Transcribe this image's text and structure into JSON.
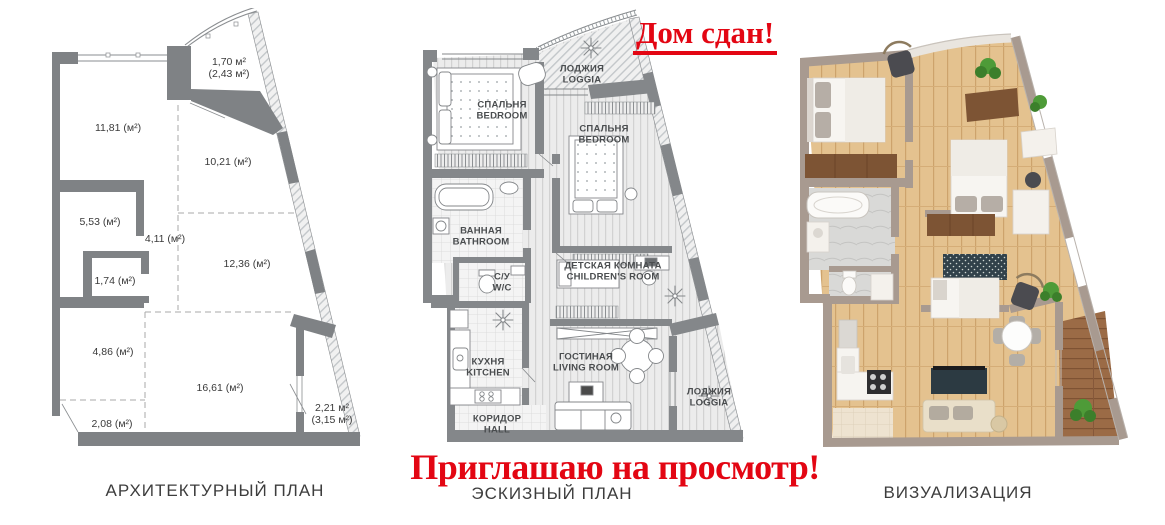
{
  "banners": {
    "top": "Дом сдан!",
    "bottom": "Приглашаю на просмотр!"
  },
  "panels": {
    "architectural": {
      "caption": "АРХИТЕКТУРНЫЙ ПЛАН",
      "rooms": [
        {
          "area": "11,81 (м²)"
        },
        {
          "area": "10,21 (м²)"
        },
        {
          "area": "5,53 (м²)"
        },
        {
          "area": "4,11 (м²)"
        },
        {
          "area": "1,74 (м²)"
        },
        {
          "area": "12,36 (м²)"
        },
        {
          "area": "4,86 (м²)"
        },
        {
          "area": "16,61 (м²)"
        },
        {
          "area": "2,08 (м²)"
        },
        {
          "area_line1": "2,21 м²",
          "area_line2": "(3,15 м²)"
        },
        {
          "area_line1": "1,70 м²",
          "area_line2": "(2,43 м²)"
        }
      ]
    },
    "sketch": {
      "caption": "ЭСКИЗНЫЙ ПЛАН",
      "rooms": [
        {
          "ru": "ЛОДЖИЯ",
          "en": "LOGGIA"
        },
        {
          "ru": "СПАЛЬНЯ",
          "en": "BEDROOM"
        },
        {
          "ru": "СПАЛЬНЯ",
          "en": "BEDROOM"
        },
        {
          "ru": "ВАННАЯ",
          "en": "BATHROOM"
        },
        {
          "ru": "С/У",
          "en": "W/C"
        },
        {
          "ru": "ДЕТСКАЯ КОМНАТА",
          "en": "CHILDREN'S ROOM"
        },
        {
          "ru": "КУХНЯ",
          "en": "KITCHEN"
        },
        {
          "ru": "ГОСТИНАЯ",
          "en": "LIVING ROOM"
        },
        {
          "ru": "КОРИДОР",
          "en": "HALL"
        },
        {
          "ru": "ЛОДЖИЯ",
          "en": "LOGGIA"
        }
      ]
    },
    "visualization": {
      "caption": "ВИЗУАЛИЗАЦИЯ"
    }
  },
  "colors": {
    "accent_red": "#e30613",
    "wall_gray": "#7f8285",
    "wall_taupe": "#a89a90",
    "wood_floor": "#e4c28f",
    "caption_gray": "#3d3d3d"
  }
}
